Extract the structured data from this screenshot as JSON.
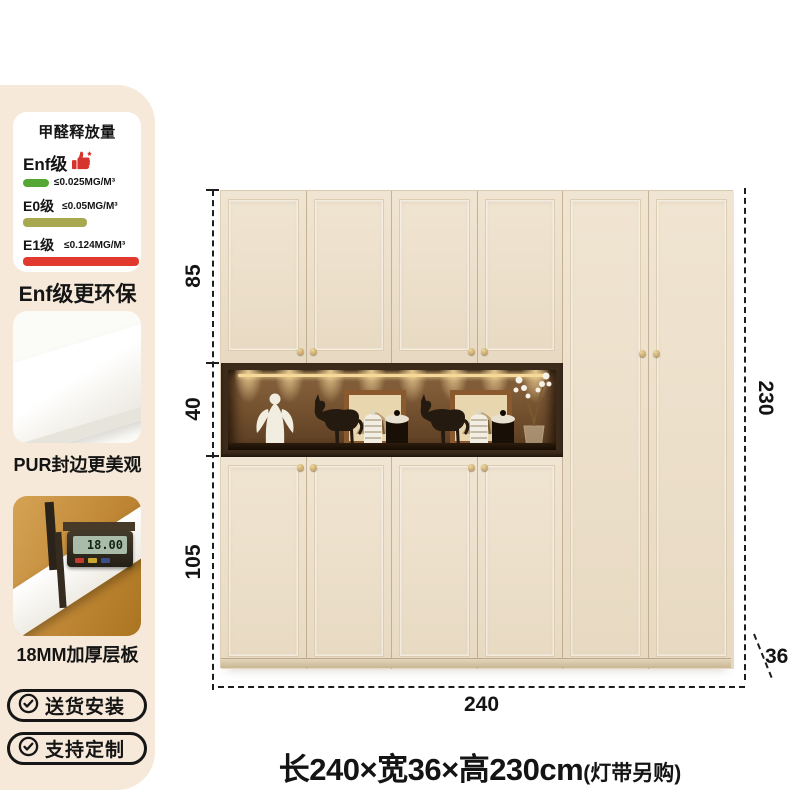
{
  "sidebar": {
    "bg_color": "#f6e9d9",
    "formaldehyde_panel": {
      "title": "甲醛释放量",
      "thumb_color": "#d6342c",
      "grades": [
        {
          "label": "Enf级",
          "value": "≤0.025MG/M³",
          "bar_color": "#55a733",
          "bar_width": "26px",
          "icon": "thumbs-up-star-icon"
        },
        {
          "label": "E0级",
          "value": "≤0.05MG/M³",
          "bar_color": "#a8a851",
          "bar_width": "64px"
        },
        {
          "label": "E1级",
          "value": "≤0.124MG/M³",
          "bar_color": "#e2392f",
          "bar_width": "116px"
        }
      ]
    },
    "eco_note": "Enf级更环保",
    "features": [
      {
        "label": "PUR封边更美观",
        "image": "board-corner-photo"
      },
      {
        "label": "18MM加厚层板",
        "image": "digital-caliper-photo",
        "caliper_reading": "18.00"
      }
    ],
    "badges": [
      {
        "icon": "check-circle-icon",
        "label": "送货安装"
      },
      {
        "icon": "check-circle-icon",
        "label": "支持定制"
      }
    ]
  },
  "diagram": {
    "dims": {
      "upper": "85",
      "niche": "40",
      "lower": "105",
      "height": "230",
      "width": "240",
      "depth": "36"
    },
    "caption": {
      "size": "长240×宽36×高230cm",
      "note": "(灯带另购)"
    },
    "cabinet": {
      "door_color": "#ece0cb",
      "knob_color": "#c8a25e",
      "niche_wood_color": "#3c2b1a",
      "niche_glow_color": "#ffe2a4"
    }
  }
}
